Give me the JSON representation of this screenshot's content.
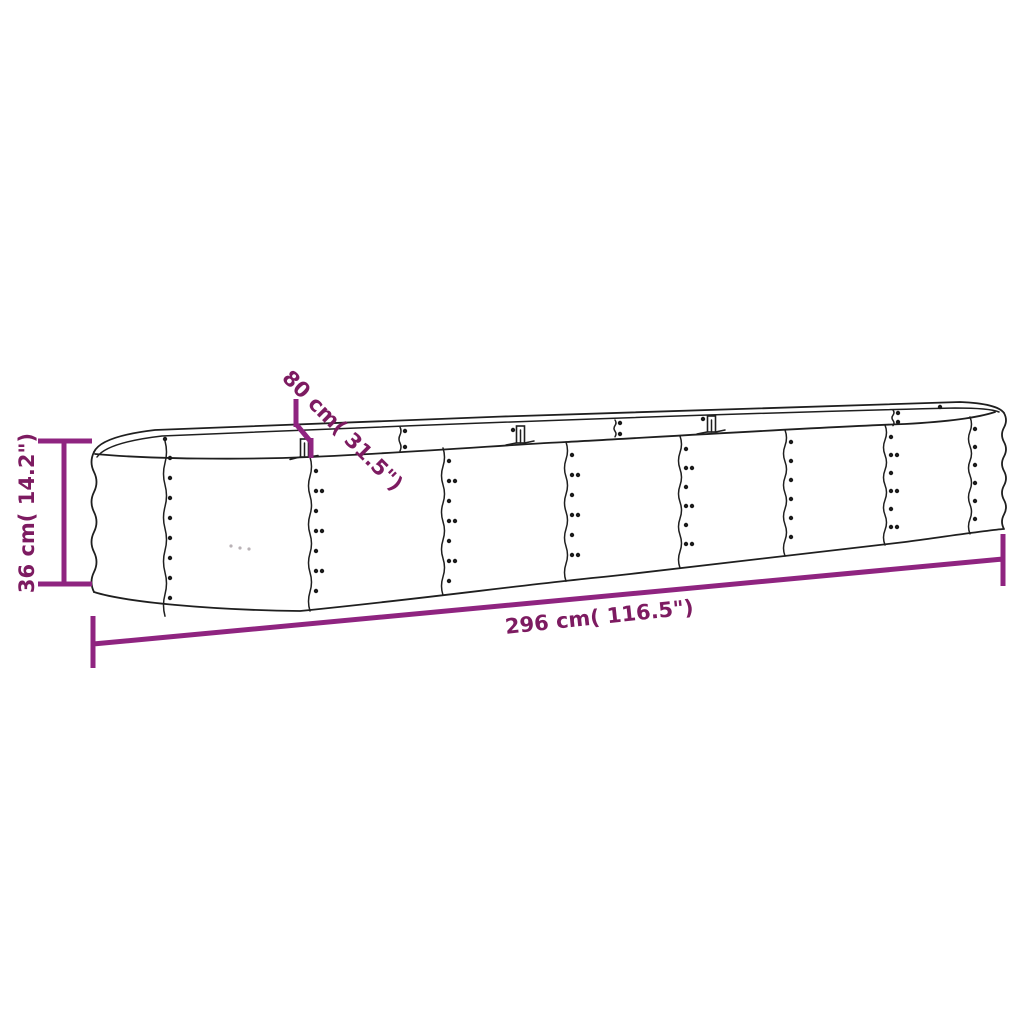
{
  "drawing": {
    "height_label": "36 cm( 14.2\")",
    "width_label": "80 cm( 31.5\")",
    "length_label": "296 cm( 116.5\")"
  },
  "colors": {
    "dimension": "#8f2480",
    "dimension_text": "#7d1b61",
    "outline": "#1f1f1f",
    "background": "#ffffff"
  }
}
